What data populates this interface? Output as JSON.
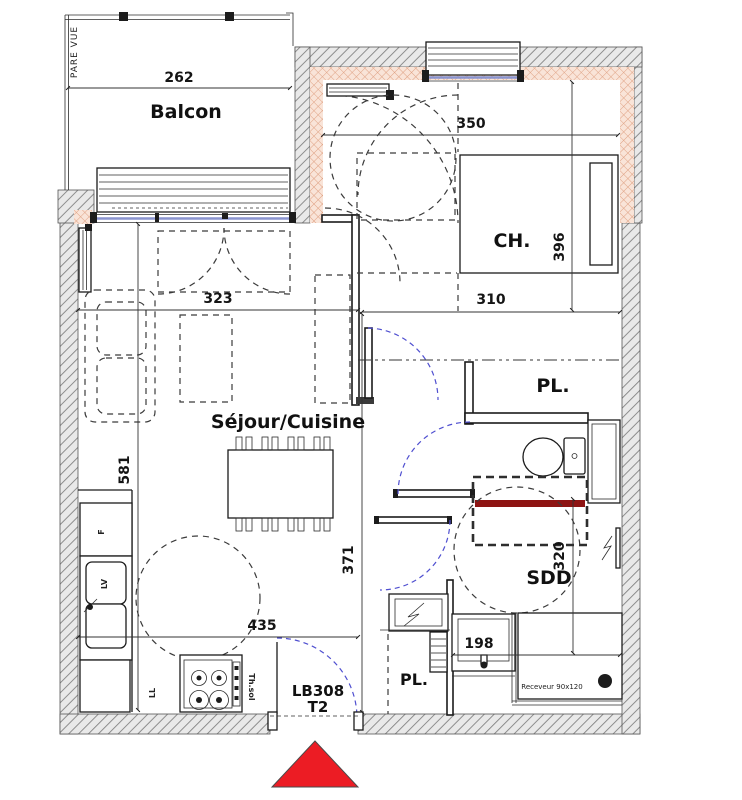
{
  "unit": {
    "code": "LB308",
    "type": "T2"
  },
  "rooms": {
    "balcony": "Balcon",
    "bedroom": "CH.",
    "living": "Séjour/Cuisine",
    "closet_top": "PL.",
    "closet_bottom": "PL.",
    "shower_room": "SDD"
  },
  "dims": {
    "balcony_width": "262",
    "bedroom_width": "350",
    "bedroom_depth": "396",
    "corridor_width": "310",
    "living_width": "323",
    "living_depth": "581",
    "kitchen_width": "435",
    "hall_depth": "371",
    "shower_depth": "320",
    "shower_width": "198"
  },
  "labels": {
    "privacy_screen": "PARE VUE",
    "shower_tray": "Receveur 90x120",
    "floor_thermostat": "Th.sol",
    "fridge": "F",
    "dishwasher": "LV",
    "washing_machine": "LL"
  },
  "colors": {
    "entrance_marker_red": "#ec1c24",
    "accent_wall_red": "#8e1413",
    "glazing_blue": "#8a94cf",
    "door_swing_blue": "#4f4fd0",
    "insulation_pink": "#dfa183",
    "wall_gray": "#838383"
  }
}
